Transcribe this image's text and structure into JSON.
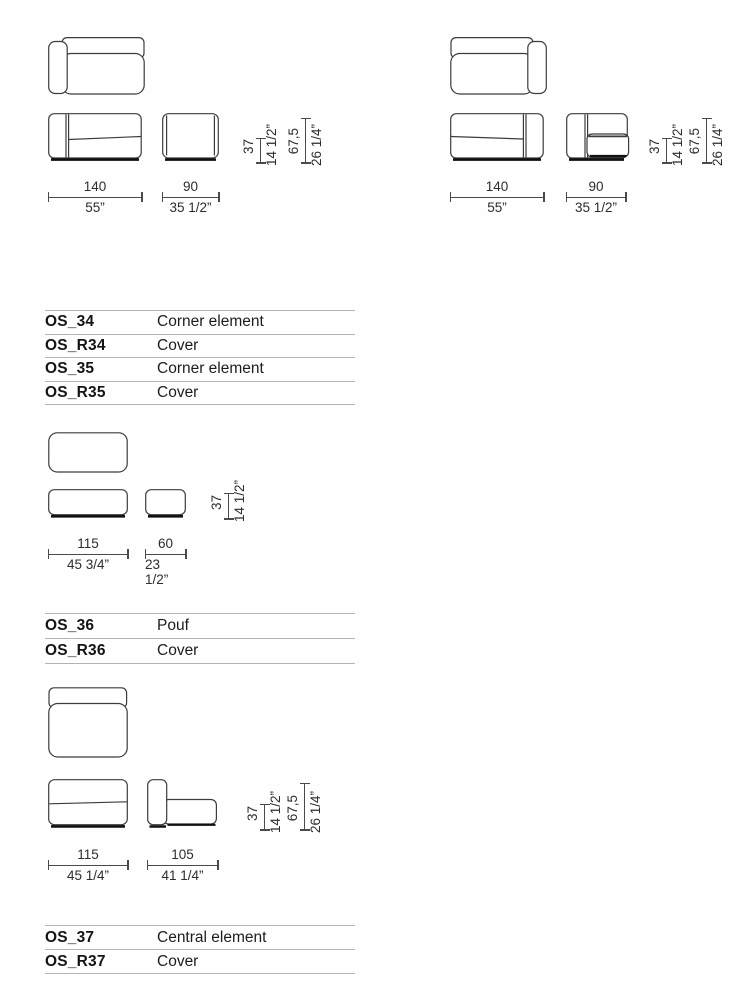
{
  "colors": {
    "background": "#fefefe",
    "drawing_line": "#3c3c3c",
    "drawing_base": "#111111",
    "dimension_line": "#4a4a4a",
    "table_divider": "#b3b3b3",
    "text": "#1d1d1d"
  },
  "drawings": {
    "corner_left": {
      "width_main_cm": "140",
      "width_main_in": "55”",
      "width_side_cm": "90",
      "width_side_in": "35 1/2”",
      "height_seat_cm": "37",
      "height_seat_in": "14 1/2”",
      "height_total_cm": "67,5",
      "height_total_in": "26 1/4”"
    },
    "corner_right": {
      "width_main_cm": "140",
      "width_main_in": "55”",
      "width_side_cm": "90",
      "width_side_in": "35 1/2”",
      "height_seat_cm": "37",
      "height_seat_in": "14 1/2”",
      "height_total_cm": "67,5",
      "height_total_in": "26 1/4”"
    },
    "pouf": {
      "width_main_cm": "115",
      "width_main_in": "45 3/4”",
      "width_side_cm": "60",
      "width_side_in": "23 1/2”",
      "height_seat_cm": "37",
      "height_seat_in": "14 1/2”"
    },
    "central": {
      "width_main_cm": "115",
      "width_main_in": "45 1/4”",
      "width_side_cm": "105",
      "width_side_in": "41 1/4”",
      "height_seat_cm": "37",
      "height_seat_in": "14 1/2”",
      "height_total_cm": "67,5",
      "height_total_in": "26 1/4”"
    }
  },
  "tables": [
    {
      "rows": [
        {
          "code": "OS_34",
          "label": "Corner element"
        },
        {
          "code": "OS_R34",
          "label": "Cover"
        },
        {
          "code": "OS_35",
          "label": "Corner element"
        },
        {
          "code": "OS_R35",
          "label": "Cover"
        }
      ]
    },
    {
      "rows": [
        {
          "code": "OS_36",
          "label": "Pouf"
        },
        {
          "code": "OS_R36",
          "label": "Cover"
        }
      ]
    },
    {
      "rows": [
        {
          "code": "OS_37",
          "label": "Central element"
        },
        {
          "code": "OS_R37",
          "label": "Cover"
        }
      ]
    }
  ]
}
